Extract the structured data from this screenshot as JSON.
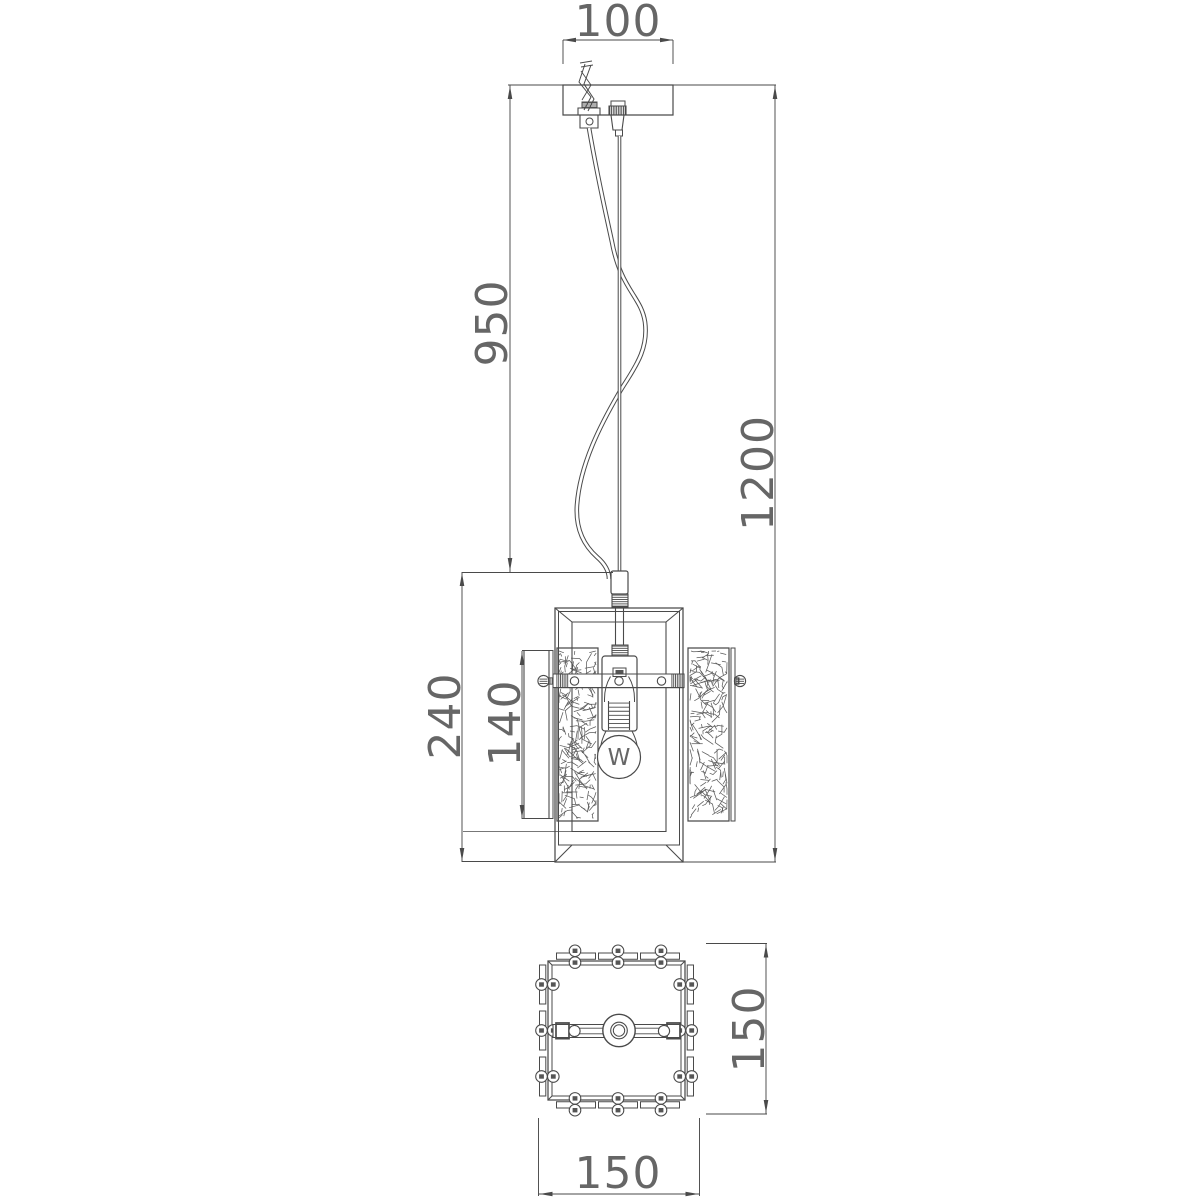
{
  "drawing": {
    "type": "technical-dimension-drawing",
    "subject": "pendant-lamp",
    "views": {
      "front": "front elevation with suspension",
      "bottom": "plan view of lantern body"
    }
  },
  "dimensions": {
    "canopy_width": "100",
    "suspension_height": "950",
    "total_height": "1200",
    "body_height": "240",
    "panel_height": "140",
    "plan_height": "150",
    "plan_width": "150"
  },
  "bulb": {
    "symbol": "W"
  },
  "colors": {
    "background": "#ffffff",
    "line": "#4a4a4a",
    "text": "#525252",
    "dark_fill": "#555555"
  }
}
